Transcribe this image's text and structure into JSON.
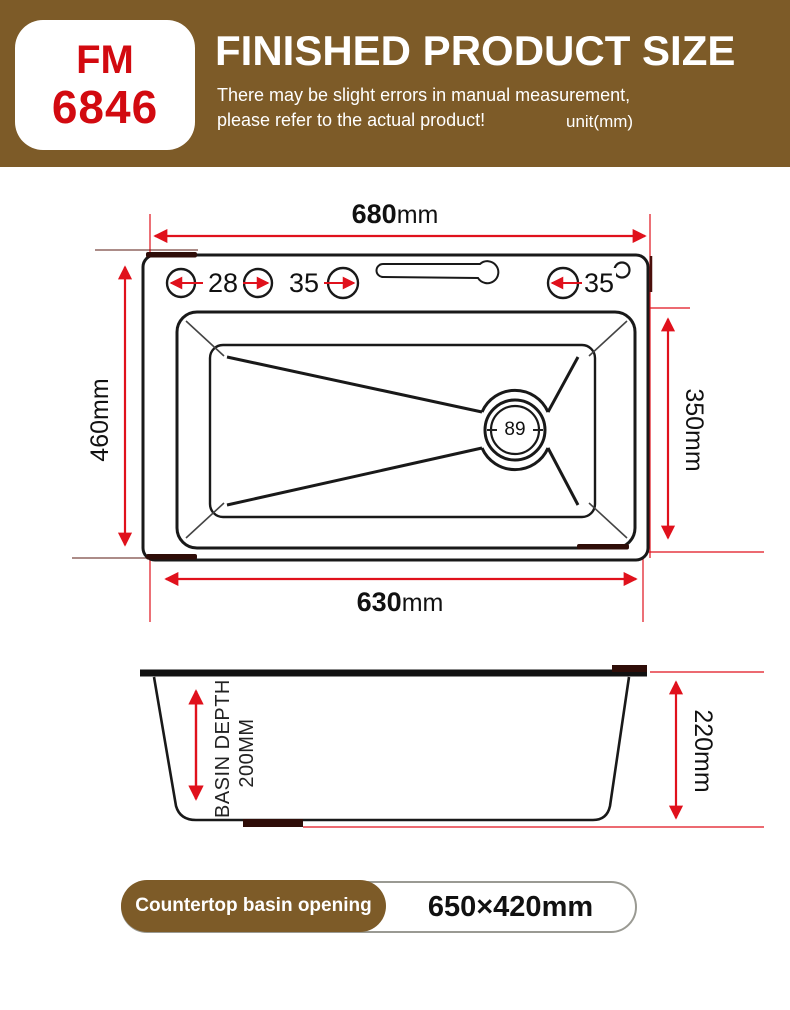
{
  "header": {
    "model": {
      "line1": "FM",
      "line2": "6846"
    },
    "title": "FINISHED PRODUCT SIZE",
    "note_line1": "There may be slight errors in manual measurement,",
    "note_line2": "please refer to the actual product!",
    "unit": "unit(mm)"
  },
  "top_view": {
    "dim_top": {
      "value": "680",
      "unit": "mm"
    },
    "dim_left": {
      "value": "460",
      "unit": "mm"
    },
    "dim_right": {
      "value": "350",
      "unit": "mm"
    },
    "dim_bottom": {
      "value": "630",
      "unit": "mm"
    },
    "hole1": "28",
    "hole2": "35",
    "hole3": "35",
    "drain_diameter": "89"
  },
  "side_view": {
    "depth_line1": "BASIN DEPTH",
    "depth_line2": "200MM",
    "dim_height": {
      "value": "220",
      "unit": "mm"
    }
  },
  "footer": {
    "label": "Countertop basin opening",
    "value": "650×420mm"
  },
  "colors": {
    "band_brown": "#7d5b28",
    "model_red": "#d20a10",
    "dimension_red": "#e0111c",
    "line_black": "#191919"
  }
}
